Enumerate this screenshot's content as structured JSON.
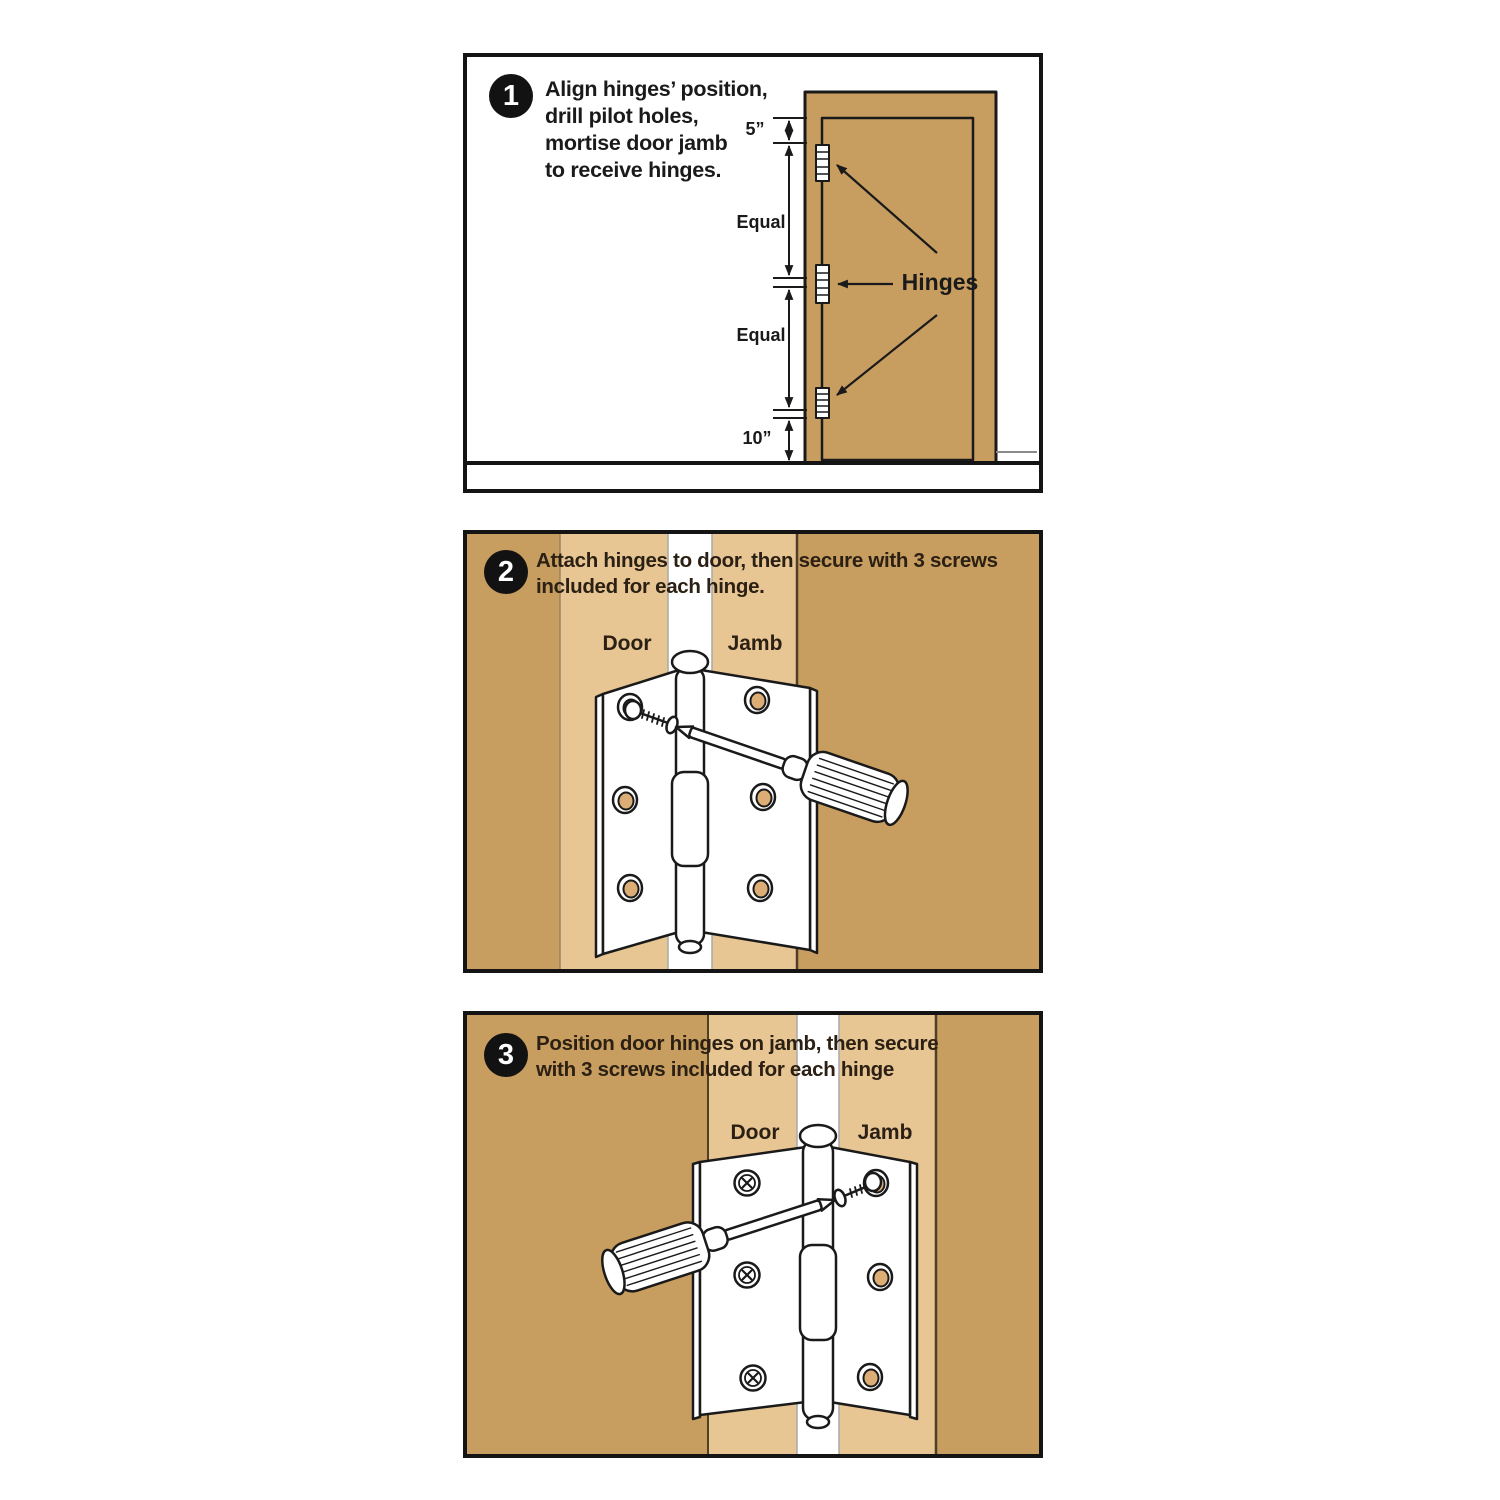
{
  "colors": {
    "wood": "#C89E60",
    "wood-light": "#E7C694",
    "hole-tan": "#DCAE76",
    "outline": "#1a1a1a",
    "text": "#2b2013",
    "badge-bg": "#121212",
    "badge-text": "#ffffff"
  },
  "panels": [
    {
      "step_number": "1",
      "instruction_lines": [
        "Align hinges’ position,",
        "drill pilot holes,",
        "mortise door jamb",
        "to receive hinges."
      ],
      "dimension_labels": {
        "top": "5”",
        "upper_gap": "Equal",
        "lower_gap": "Equal",
        "bottom": "10”"
      },
      "hinges_label": "Hinges"
    },
    {
      "step_number": "2",
      "instruction_lines": [
        "Attach hinges to door, then secure with 3 screws",
        "included for each hinge."
      ],
      "door_label": "Door",
      "jamb_label": "Jamb"
    },
    {
      "step_number": "3",
      "instruction_lines": [
        "Position door hinges on jamb, then secure",
        "with 3 screws included for each hinge"
      ],
      "door_label": "Door",
      "jamb_label": "Jamb"
    }
  ]
}
